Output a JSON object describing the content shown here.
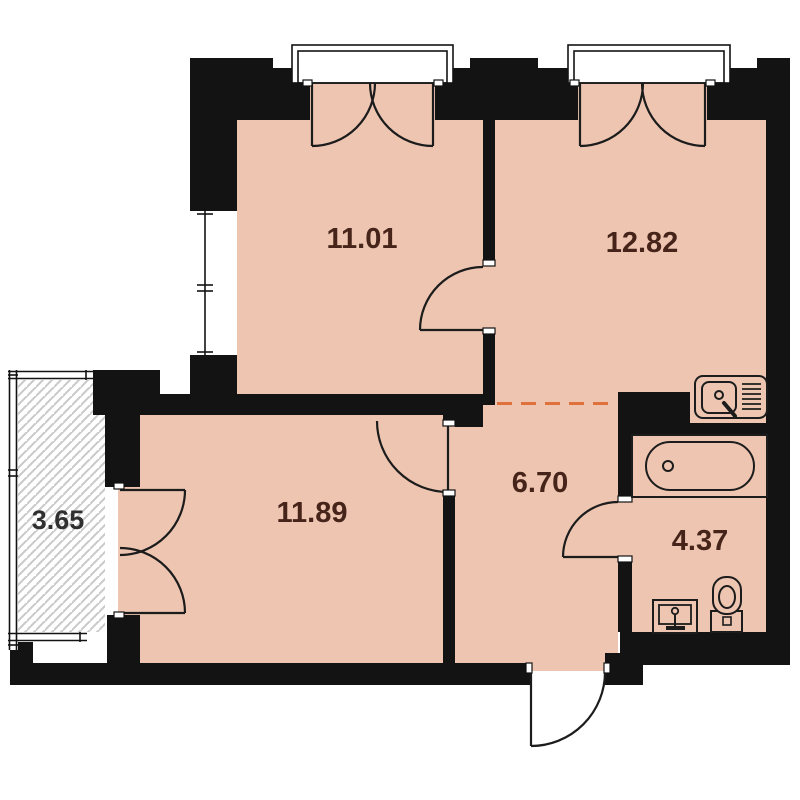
{
  "title": "apartment-floor-plan",
  "rooms": [
    {
      "key": "room-top-left",
      "area": "11.01"
    },
    {
      "key": "kitchen-living",
      "area": "12.82"
    },
    {
      "key": "balcony",
      "area": "3.65"
    },
    {
      "key": "room-bottom",
      "area": "11.89"
    },
    {
      "key": "hallway",
      "area": "6.70"
    },
    {
      "key": "bathroom",
      "area": "4.37"
    }
  ],
  "colors": {
    "floor_fill": "#edc5b1",
    "wall_fill": "#131313",
    "hatch_line": "#c9c9c9",
    "open_boundary_dash": "#e0703c",
    "label_text": "#46241a"
  },
  "icons": [
    "kitchen-sink-icon",
    "bathtub-icon",
    "toilet-icon",
    "washbasin-icon"
  ]
}
